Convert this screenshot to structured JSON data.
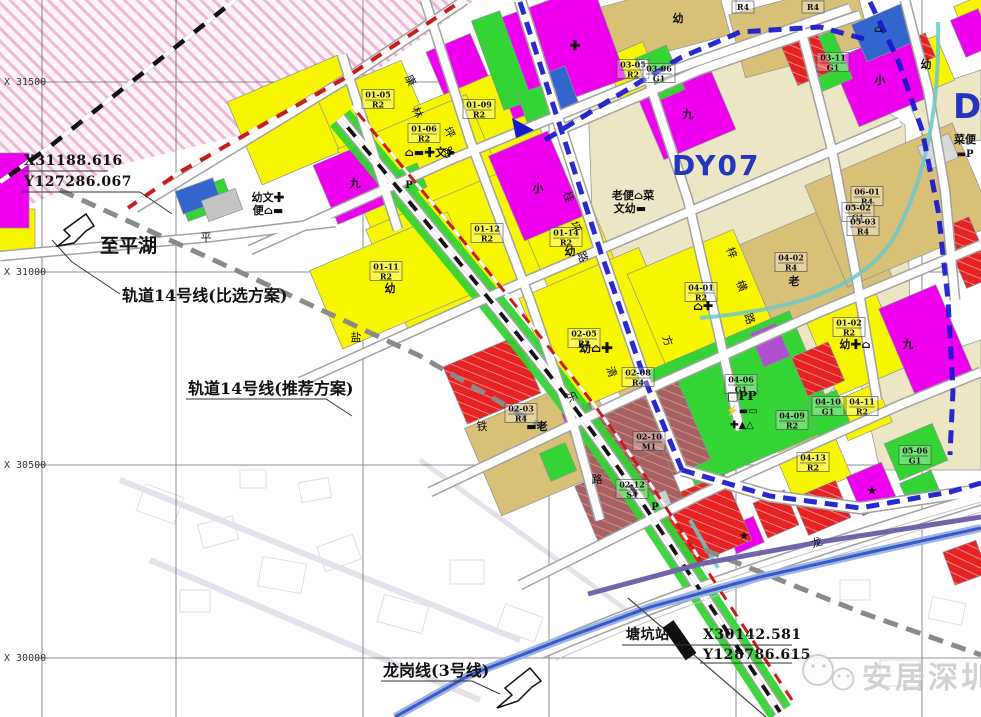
{
  "map": {
    "grid": {
      "row_labels": [
        "X 31500",
        "X 31000",
        "X 30500",
        "X 30000"
      ]
    },
    "districts": {
      "dy07": "DY07",
      "dy_edge": "DY"
    },
    "annotations": {
      "to_pinghu": "至平湖",
      "rail14_alt": "轨道14号线(比选方案)",
      "rail14_rec": "轨道14号线(推荐方案)",
      "longgang": "龙岗线(3号线)",
      "station": "塘坑站",
      "coord_nw_x": "X31188.616",
      "coord_nw_y": "Y127286.067",
      "coord_se_x": "X30142.581",
      "coord_se_y": "Y128786.615"
    },
    "watermark": "安居深圳",
    "zone_colors": {
      "residential_yellow": "#f8f500",
      "school_magenta": "#ee00ee",
      "green_space": "#33d434",
      "commercial_red": "#e62222",
      "industrial_maroon": "#a86060",
      "village_tan": "#d9c077",
      "built_cream": "#ede6c4",
      "boundary_blue": "#1717cd",
      "metro_blue": "#3a58c8",
      "canal_teal": "#6cc8c8"
    },
    "parcels": [
      {
        "code": "01-05",
        "cls": "R2",
        "x": 378,
        "y": 99
      },
      {
        "code": "01-06",
        "cls": "R2",
        "x": 424,
        "y": 133
      },
      {
        "code": "01-09",
        "cls": "R2",
        "x": 479,
        "y": 109
      },
      {
        "code": "01-12",
        "cls": "R2",
        "x": 487,
        "y": 233
      },
      {
        "code": "01-14",
        "cls": "R2",
        "x": 566,
        "y": 237
      },
      {
        "code": "01-11",
        "cls": "R2",
        "x": 386,
        "y": 271
      },
      {
        "code": "02-05",
        "cls": "R2",
        "x": 584,
        "y": 338
      },
      {
        "code": "02-08",
        "cls": "R4",
        "x": 638,
        "y": 377
      },
      {
        "code": "02-03",
        "cls": "R4",
        "x": 521,
        "y": 413
      },
      {
        "code": "02-10",
        "cls": "M1",
        "x": 649,
        "y": 441
      },
      {
        "code": "02-12",
        "cls": "S4",
        "x": 632,
        "y": 489
      },
      {
        "code": "03-05",
        "cls": "R2",
        "x": 633,
        "y": 69
      },
      {
        "code": "03-06",
        "cls": "G1",
        "x": 659,
        "y": 73
      },
      {
        "code": "03-11",
        "cls": "G1",
        "x": 833,
        "y": 62
      },
      {
        "code": "04-01",
        "cls": "R2",
        "x": 701,
        "y": 292
      },
      {
        "code": "04-02",
        "cls": "R4",
        "x": 791,
        "y": 262
      },
      {
        "code": "01-02",
        "cls": "R2",
        "x": 849,
        "y": 327
      },
      {
        "code": "04-06",
        "cls": "G1",
        "x": 741,
        "y": 384
      },
      {
        "code": "04-09",
        "cls": "R2",
        "x": 792,
        "y": 420
      },
      {
        "code": "04-10",
        "cls": "G1",
        "x": 828,
        "y": 406
      },
      {
        "code": "04-11",
        "cls": "R2",
        "x": 862,
        "y": 406
      },
      {
        "code": "04-13",
        "cls": "R2",
        "x": 813,
        "y": 462
      },
      {
        "code": "06-01",
        "cls": "R4",
        "x": 867,
        "y": 196
      },
      {
        "code": "05-02",
        "cls": "G1",
        "x": 858,
        "y": 212
      },
      {
        "code": "05-03",
        "cls": "R4",
        "x": 863,
        "y": 226
      },
      {
        "code": "05-06",
        "cls": "G1",
        "x": 915,
        "y": 455
      }
    ],
    "facilities": [
      {
        "t": "幼文✚",
        "x": 268,
        "y": 201,
        "s": 11
      },
      {
        "t": "便⌂▬",
        "x": 268,
        "y": 214,
        "s": 11
      },
      {
        "t": "⌂▬✚文➤",
        "x": 430,
        "y": 156,
        "s": 11
      },
      {
        "t": "P",
        "x": 409,
        "y": 188,
        "s": 10
      },
      {
        "t": "老便⌂菜",
        "x": 633,
        "y": 199,
        "s": 11
      },
      {
        "t": "文幼▬",
        "x": 630,
        "y": 212,
        "s": 11
      },
      {
        "t": "幼⌂✚",
        "x": 596,
        "y": 352,
        "s": 12
      },
      {
        "t": "⌂✚",
        "x": 703,
        "y": 310,
        "s": 12
      },
      {
        "t": "幼✚⌂",
        "x": 855,
        "y": 348,
        "s": 11
      },
      {
        "t": "老",
        "x": 794,
        "y": 285,
        "s": 11
      },
      {
        "t": "□PP",
        "x": 742,
        "y": 400,
        "s": 12
      },
      {
        "t": "⚡▬▭",
        "x": 742,
        "y": 414,
        "s": 10
      },
      {
        "t": "✚▲△",
        "x": 742,
        "y": 428,
        "s": 10
      },
      {
        "t": "▬老",
        "x": 537,
        "y": 430,
        "s": 11
      },
      {
        "t": "P",
        "x": 655,
        "y": 510,
        "s": 10
      },
      {
        "t": "菜便",
        "x": 965,
        "y": 143,
        "s": 11
      },
      {
        "t": "▬P",
        "x": 965,
        "y": 157,
        "s": 10
      },
      {
        "t": "幼",
        "x": 926,
        "y": 68,
        "s": 11
      },
      {
        "t": "幼",
        "x": 678,
        "y": 22,
        "s": 11
      },
      {
        "t": "幼",
        "x": 390,
        "y": 292,
        "s": 11
      },
      {
        "t": "幼",
        "x": 570,
        "y": 255,
        "s": 11
      },
      {
        "t": "九",
        "x": 688,
        "y": 118,
        "s": 11
      },
      {
        "t": "九",
        "x": 908,
        "y": 348,
        "s": 11
      },
      {
        "t": "九",
        "x": 355,
        "y": 187,
        "s": 11
      },
      {
        "t": "小",
        "x": 880,
        "y": 84,
        "s": 11
      },
      {
        "t": "小",
        "x": 538,
        "y": 192,
        "s": 11
      },
      {
        "t": "★",
        "x": 872,
        "y": 494,
        "s": 10
      },
      {
        "t": "★",
        "x": 744,
        "y": 539,
        "s": 10
      },
      {
        "t": "✚",
        "x": 575,
        "y": 50,
        "s": 13
      },
      {
        "t": "⌂",
        "x": 878,
        "y": 32,
        "s": 10
      },
      {
        "t": "R4",
        "x": 743,
        "y": 10,
        "s": 8,
        "box": true
      },
      {
        "t": "R4",
        "x": 813,
        "y": 10,
        "s": 8,
        "box": true
      }
    ],
    "road_chars": [
      {
        "t": "康",
        "x": 407,
        "y": 82,
        "r": 65
      },
      {
        "t": "林",
        "x": 414,
        "y": 114,
        "r": 65
      },
      {
        "t": "坪",
        "x": 446,
        "y": 134,
        "r": 65
      },
      {
        "t": "路",
        "x": 445,
        "y": 154,
        "r": 65
      },
      {
        "t": "桂",
        "x": 565,
        "y": 198,
        "r": 70
      },
      {
        "t": "坪",
        "x": 572,
        "y": 228,
        "r": 70
      },
      {
        "t": "路",
        "x": 579,
        "y": 258,
        "r": 70
      },
      {
        "t": "梓",
        "x": 728,
        "y": 254,
        "r": 70
      },
      {
        "t": "横",
        "x": 738,
        "y": 287,
        "r": 70
      },
      {
        "t": "路",
        "x": 746,
        "y": 320,
        "r": 70
      },
      {
        "t": "方",
        "x": 664,
        "y": 342,
        "r": 70
      },
      {
        "t": "清",
        "x": 608,
        "y": 373,
        "r": 70
      },
      {
        "t": "乐",
        "x": 568,
        "y": 398,
        "r": 70
      },
      {
        "t": "盐",
        "x": 356,
        "y": 341,
        "r": 0
      },
      {
        "t": "铁",
        "x": 482,
        "y": 430,
        "r": 0
      },
      {
        "t": "路",
        "x": 597,
        "y": 483,
        "r": 0
      },
      {
        "t": "龙",
        "x": 818,
        "y": 546,
        "r": -18
      },
      {
        "t": "平",
        "x": 206,
        "y": 241,
        "r": 0
      }
    ]
  }
}
